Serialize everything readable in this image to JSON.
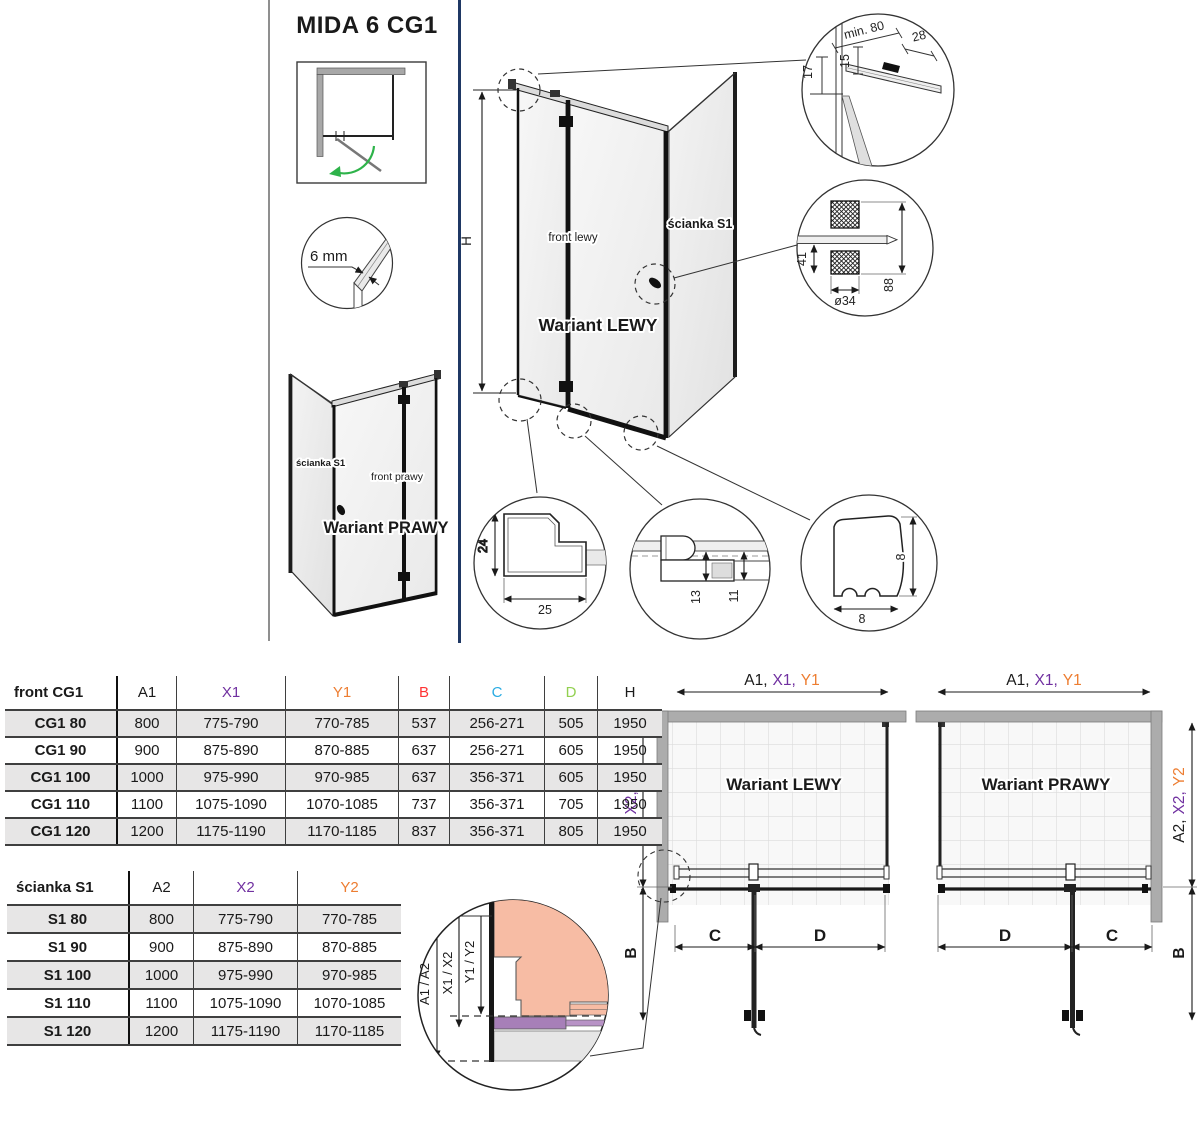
{
  "title": "MIDA 6 CG1",
  "colors": {
    "purple": "#7030A0",
    "orange": "#ED7D31",
    "red": "#FF3333",
    "cyan": "#29ABE2",
    "green": "#92D050",
    "navy_divider": "#1F3864",
    "wall_gray": "#ACACAC",
    "row_stripe": "#E7E6E6",
    "salmon": "#F7BCA4",
    "violet_seal": "#A77FB8"
  },
  "variants": {
    "main": {
      "front_label": "front lewy",
      "wall_label": "ścianka S1",
      "name": "Wariant LEWY",
      "height": "H"
    },
    "small": {
      "front_label": "front prawy",
      "wall_label": "ścianka S1",
      "name": "Wariant PRAWY"
    }
  },
  "plans": {
    "left": {
      "name": "Wariant LEWY"
    },
    "right": {
      "name": "Wariant PRAWY"
    }
  },
  "dim_labels": {
    "a1": "A1,",
    "x1": "X1,",
    "y1": "Y1",
    "a2": "A2,",
    "x2": "X2,",
    "y2": "Y2",
    "b": "B",
    "c": "C",
    "d": "D"
  },
  "details": {
    "glass_thickness": "6 mm",
    "wall_profile": {
      "min80": "min. 80",
      "w28": "28",
      "h15": "15",
      "h17": "17"
    },
    "handle": {
      "h41": "41",
      "dia34": "ø34",
      "h88": "88"
    },
    "corner": {
      "h24": "24",
      "w25": "25"
    },
    "rail": {
      "h13": "13",
      "h11": "11"
    },
    "seal": {
      "h8": "8",
      "w8": "8"
    },
    "adjust": {
      "a": "A1 / A2",
      "x": "X1 / X2",
      "y": "Y1 / Y2"
    }
  },
  "tables": {
    "front": {
      "headers": [
        {
          "label": "front CG1",
          "color": "#1a1a1a"
        },
        {
          "label": "A1",
          "color": "#1a1a1a"
        },
        {
          "label": "X1",
          "color": "#7030A0"
        },
        {
          "label": "Y1",
          "color": "#ED7D31"
        },
        {
          "label": "B",
          "color": "#FF3333"
        },
        {
          "label": "C",
          "color": "#29ABE2"
        },
        {
          "label": "D",
          "color": "#92D050"
        },
        {
          "label": "H",
          "color": "#1a1a1a"
        }
      ],
      "rows": [
        [
          "CG1 80",
          "800",
          "775-790",
          "770-785",
          "537",
          "256-271",
          "505",
          "1950"
        ],
        [
          "CG1 90",
          "900",
          "875-890",
          "870-885",
          "637",
          "256-271",
          "605",
          "1950"
        ],
        [
          "CG1 100",
          "1000",
          "975-990",
          "970-985",
          "637",
          "356-371",
          "605",
          "1950"
        ],
        [
          "CG1 110",
          "1100",
          "1075-1090",
          "1070-1085",
          "737",
          "356-371",
          "705",
          "1950"
        ],
        [
          "CG1 120",
          "1200",
          "1175-1190",
          "1170-1185",
          "837",
          "356-371",
          "805",
          "1950"
        ]
      ]
    },
    "wall": {
      "headers": [
        {
          "label": "ścianka S1",
          "color": "#1a1a1a"
        },
        {
          "label": "A2",
          "color": "#1a1a1a"
        },
        {
          "label": "X2",
          "color": "#7030A0"
        },
        {
          "label": "Y2",
          "color": "#ED7D31"
        }
      ],
      "rows": [
        [
          "S1 80",
          "800",
          "775-790",
          "770-785"
        ],
        [
          "S1 90",
          "900",
          "875-890",
          "870-885"
        ],
        [
          "S1 100",
          "1000",
          "975-990",
          "970-985"
        ],
        [
          "S1 110",
          "1100",
          "1075-1090",
          "1070-1085"
        ],
        [
          "S1 120",
          "1200",
          "1175-1190",
          "1170-1185"
        ]
      ]
    }
  }
}
